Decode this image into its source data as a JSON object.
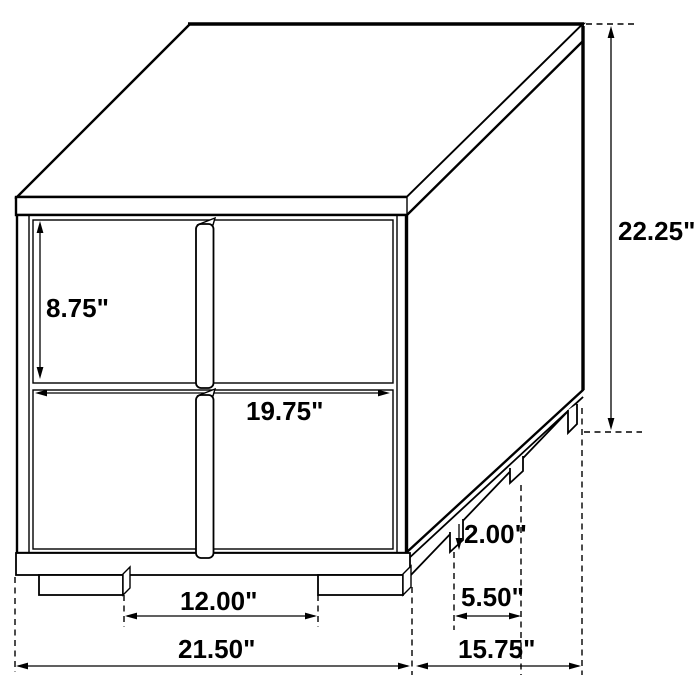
{
  "diagram": {
    "subject": "two-drawer nightstand dimension drawing",
    "dimensions": {
      "drawer_height": "8.75\"",
      "front_width": "19.75\"",
      "overall_height": "22.25\"",
      "front_leg_gap": "12.00\"",
      "overall_width": "21.50\"",
      "overall_depth": "15.75\"",
      "side_leg_gap": "5.50\"",
      "leg_height": "2.00\""
    }
  }
}
